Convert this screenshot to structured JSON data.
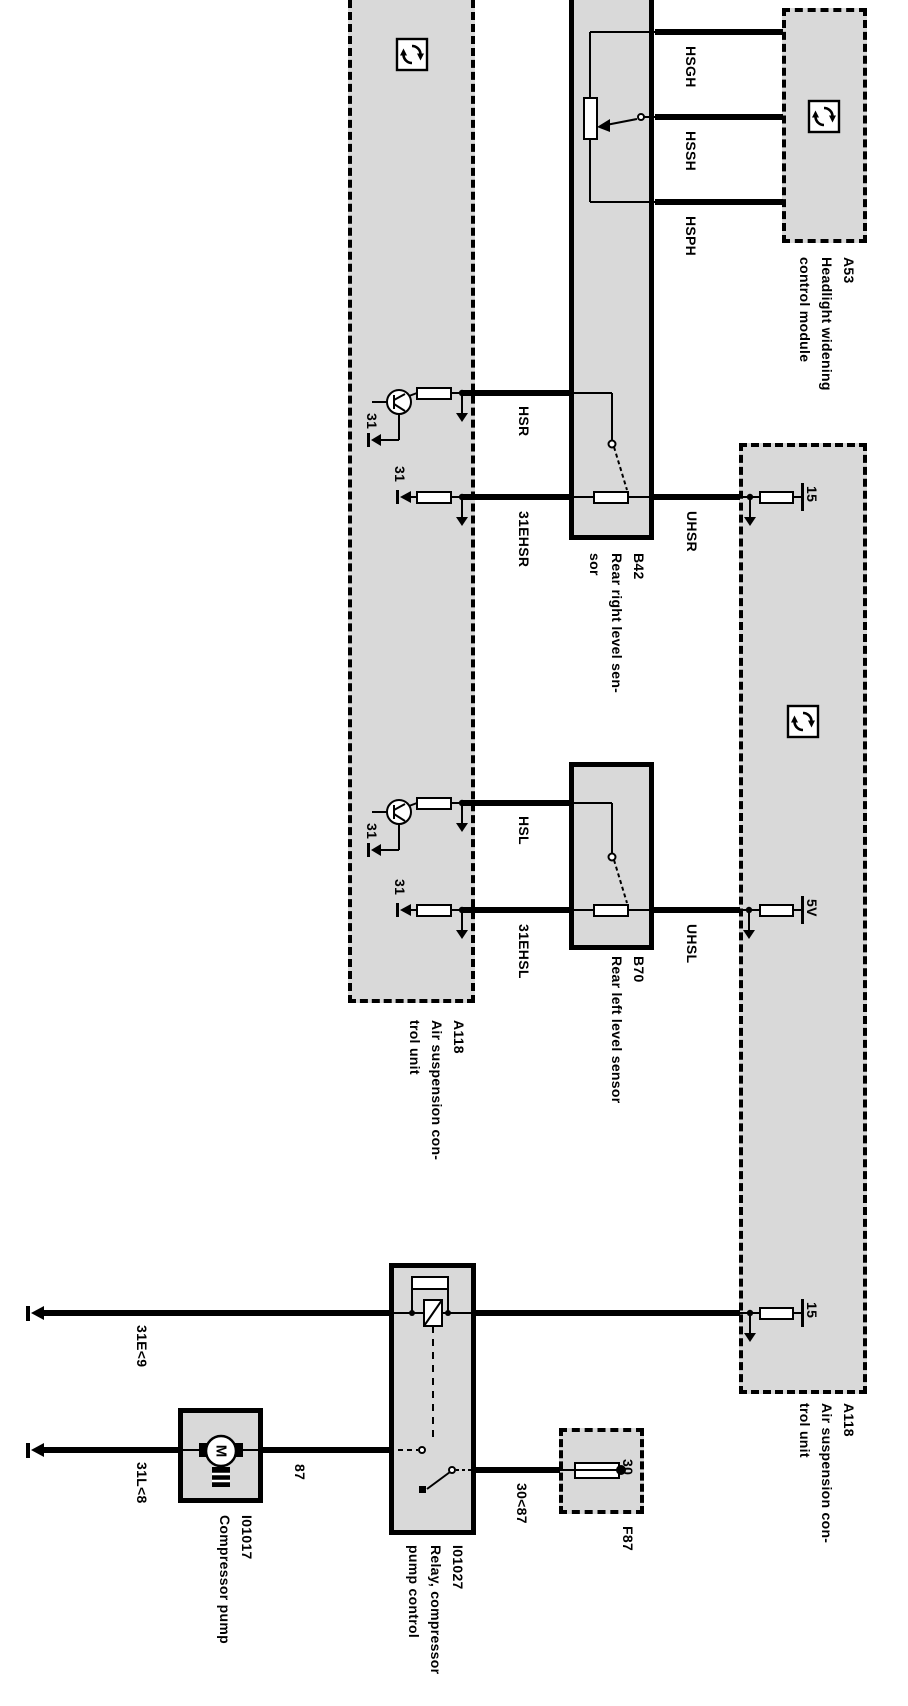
{
  "colors": {
    "background": "#ffffff",
    "line": "#000000",
    "module_fill": "#d9d9d9"
  },
  "modules": {
    "a53": {
      "label": "A53\nHeadlight widening\ncontrol module"
    },
    "a118_left": {
      "label": "A118\nAir suspension con-\ntrol unit"
    },
    "a118_right": {
      "label": "A118\nAir suspension con-\ntrol unit"
    },
    "b42": {
      "label": "B42\nRear right level sen-\nsor"
    },
    "b70": {
      "label": "B70\nRear left level sensor"
    },
    "i01017": {
      "label": "I01017\nCompressor pump"
    },
    "i01027": {
      "label": "I01027\nRelay, compressor\npump control"
    },
    "f87": {
      "label": "F87"
    }
  },
  "wire_labels": {
    "hsgh": "HSGH",
    "hssh": "HSSH",
    "hsph": "HSPH",
    "hsr": "HSR",
    "ehsr": "31EHSR",
    "uhsr": "UHSR",
    "hsl": "HSL",
    "ehsl": "31EHSL",
    "uhsl": "UHSL",
    "e9": "31E<9",
    "l8": "31L<8",
    "w87": "87",
    "w3087": "30<87"
  },
  "terminal_labels": {
    "t15_top": "15",
    "t5v": "5V",
    "t15_bottom": "15",
    "t30": "30",
    "gnd_hsr": "31",
    "gnd_ehsr": "31",
    "gnd_hsl": "31",
    "gnd_ehsl": "31"
  }
}
